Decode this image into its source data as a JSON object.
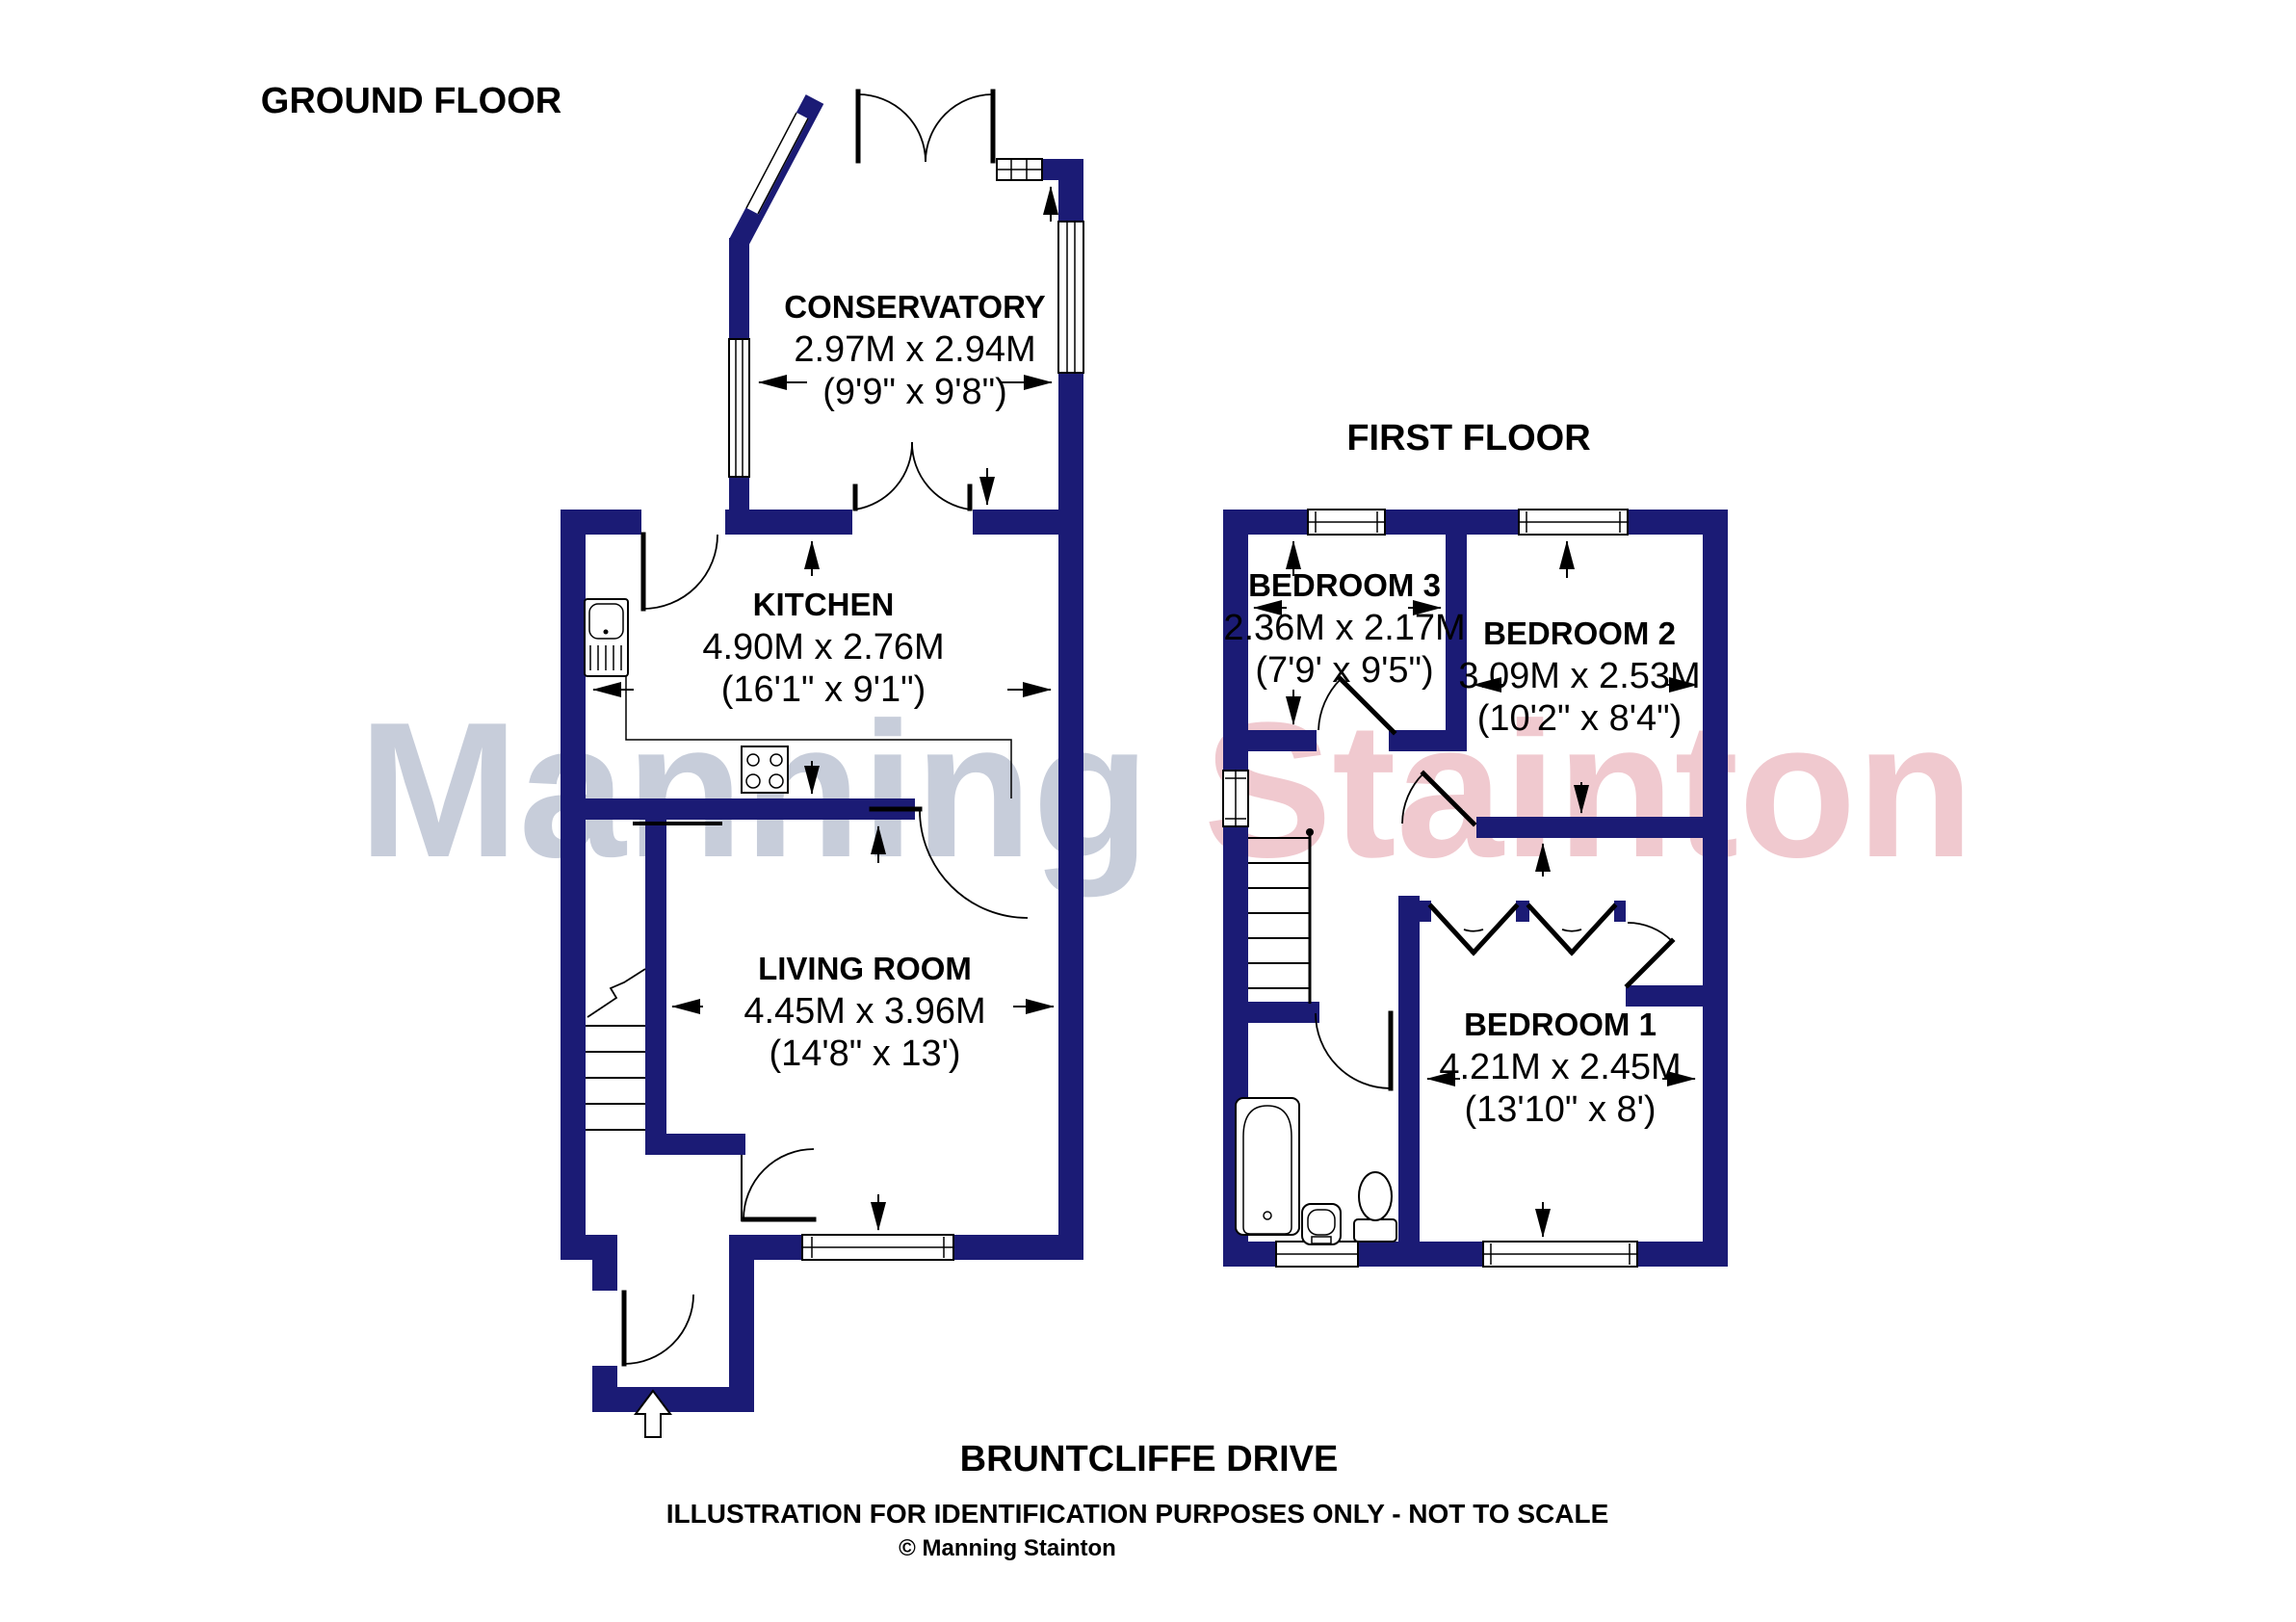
{
  "ground_floor": {
    "title": "GROUND FLOOR",
    "conservatory": {
      "name": "CONSERVATORY",
      "metric": "2.97M x 2.94M",
      "imperial": "(9'9\" x 9'8\")"
    },
    "kitchen": {
      "name": "KITCHEN",
      "metric": "4.90M x 2.76M",
      "imperial": "(16'1\" x 9'1\")"
    },
    "living_room": {
      "name": "LIVING ROOM",
      "metric": "4.45M x 3.96M",
      "imperial": "(14'8\" x 13')"
    }
  },
  "first_floor": {
    "title": "FIRST FLOOR",
    "bedroom_3": {
      "name": "BEDROOM 3",
      "metric": "2.36M x 2.17M",
      "imperial": "(7'9' x 9'5\")"
    },
    "bedroom_2": {
      "name": "BEDROOM 2",
      "metric": "3.09M x 2.53M",
      "imperial": "(10'2\" x 8'4\")"
    },
    "bedroom_1": {
      "name": "BEDROOM 1",
      "metric": "4.21M x 2.45M",
      "imperial": "(13'10\" x 8')"
    }
  },
  "footer": {
    "street": "BRUNTCLIFFE DRIVE",
    "disclaimer": "ILLUSTRATION FOR IDENTIFICATION PURPOSES ONLY - NOT TO SCALE",
    "copyright": "© Manning Stainton"
  },
  "watermark": {
    "word_1": "Manning",
    "word_2": "Stainton",
    "color_1": "#c7cdda",
    "color_2": "#f0c9cf"
  },
  "colors": {
    "wall": "#1b1b75"
  }
}
